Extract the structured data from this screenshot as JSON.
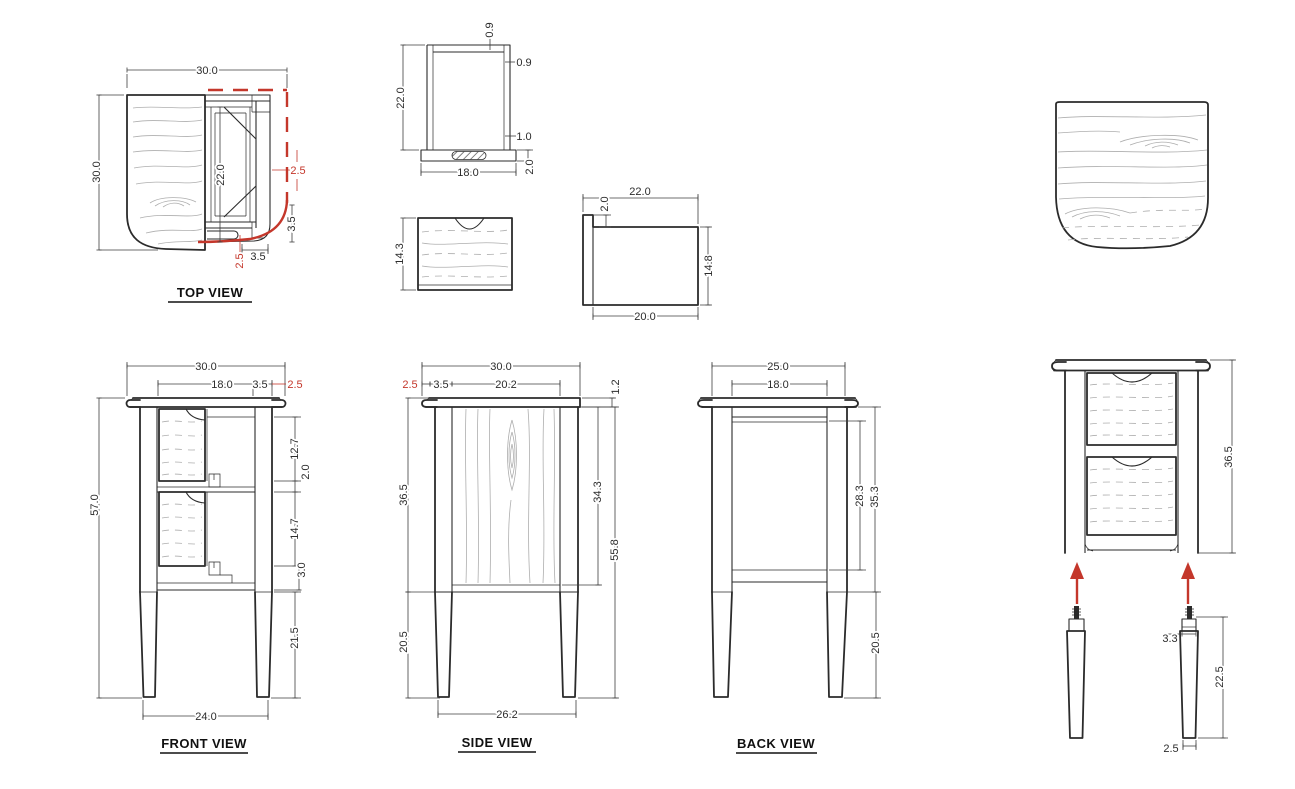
{
  "meta": {
    "colors": {
      "line": "#2b2b2b",
      "dim": "#3f3f3f",
      "grain": "#aeaeae",
      "red": "#c4372b",
      "bg": "#ffffff"
    }
  },
  "views": {
    "top": {
      "label": "TOP VIEW",
      "dims": {
        "overall_width": "30.0",
        "overall_depth": "30.0",
        "opening_depth": "22.0",
        "side_overhang": "2.5",
        "side_frame": "3.5",
        "front_overhang": "2.5",
        "front_frame": "3.5"
      }
    },
    "frame": {
      "dims": {
        "height": "22.0",
        "top_rail": "0.9",
        "stile": "0.9",
        "bottom_rail": "1.0",
        "width": "18.0",
        "base": "2.0"
      }
    },
    "drawer_front": {
      "dims": {
        "height": "14.3"
      }
    },
    "drawer_side": {
      "dims": {
        "length": "22.0",
        "lip": "2.0",
        "height": "14.8",
        "body_length": "20.0"
      }
    },
    "front": {
      "label": "FRONT VIEW",
      "dims": {
        "overall_width": "30.0",
        "opening_width": "18.0",
        "leg_width": "3.5",
        "overhang": "2.5",
        "overall_height": "57.0",
        "upper_opening": "12.7",
        "mid_rail": "2.0",
        "lower_opening": "14.7",
        "bottom_rail": "3.0",
        "leg_height": "21.5",
        "leg_span": "24.0"
      }
    },
    "side": {
      "label": "SIDE VIEW",
      "dims": {
        "overall_depth": "30.0",
        "overhang": "2.5",
        "leg_depth": "3.5",
        "panel_depth": "20.2",
        "top_thickness": "1.2",
        "body_height": "36.5",
        "panel_height": "34.3",
        "under_top": "55.8",
        "leg_height": "20.5",
        "leg_span": "26.2"
      }
    },
    "back": {
      "label": "BACK VIEW",
      "dims": {
        "overall_width": "25.0",
        "panel_width": "18.0",
        "panel_height": "28.3",
        "body_height": "35.3",
        "leg_height": "20.5"
      }
    },
    "assembly": {
      "dims": {
        "body_height": "36.5",
        "tenon": "3.3",
        "leg_length": "22.5",
        "foot": "2.5"
      }
    }
  }
}
